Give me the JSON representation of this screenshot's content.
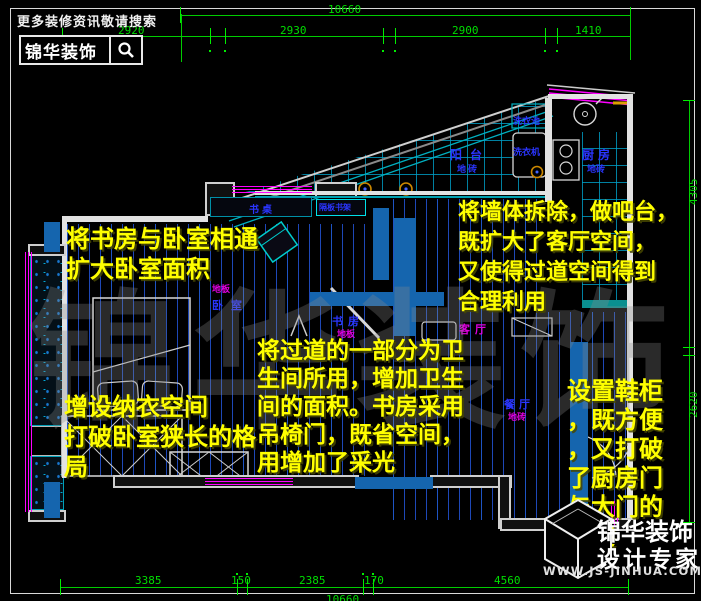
{
  "header": {
    "tagline": "更多装修资讯敬请搜索",
    "brand": "锦华装饰",
    "search_icon": "magnifier-icon"
  },
  "watermark": "锦华装饰",
  "dims": {
    "top_total": "10660",
    "top_segments": [
      "2920",
      "2930",
      "2900",
      "1410"
    ],
    "bottom_segments": [
      "3385",
      "150",
      "2385",
      "170",
      "4560"
    ],
    "bottom_total": "10660",
    "right_segments": [
      "4305",
      "2620"
    ]
  },
  "rooms": {
    "balcony": "阳台",
    "balcony_floor": "地砖",
    "kitchen": "厨房",
    "kitchen_floor": "地砖",
    "laundry_sink": "洗衣池",
    "washer": "洗衣机",
    "desk": "书桌",
    "shelf": "隔板书架",
    "study": "书房",
    "study_floor": "地板",
    "bedroom": "卧室",
    "bedroom_floor": "地板",
    "living": "客厅",
    "dining": "餐厅",
    "dining_floor": "地砖"
  },
  "annotations": {
    "study_bedroom": [
      "将书房与卧室相通",
      "扩大卧室面积"
    ],
    "closet": [
      "增设纳衣空间",
      "打破卧室狭长的格",
      "局"
    ],
    "bathroom": [
      "将过道的一部分为卫",
      "生间所用，增加卫生",
      "间的面积。书房采用",
      "吊椅门，既省空间，",
      "用增加了采光"
    ],
    "bar": [
      "将墙体拆除，做吧台，",
      "既扩大了客厅空间，",
      "又使得过道空间得到",
      "合理利用"
    ],
    "shoe_cabinet": [
      "设置鞋柜",
      "，既方便",
      "，又打破",
      "了厨房门",
      "与大门的",
      "冲突"
    ]
  },
  "footer": {
    "brand": "锦华装饰",
    "slogan": "设计专家",
    "website": "WWW.JS-JINHUA.COM"
  },
  "colors": {
    "dimension": "#00dd00",
    "annotation": "#ffff00",
    "wall": "#e2e2e2",
    "window": "#ff00ff",
    "new_wall": "#1565ae",
    "hatch": "#2355d7",
    "tile": "#00a0c8"
  }
}
